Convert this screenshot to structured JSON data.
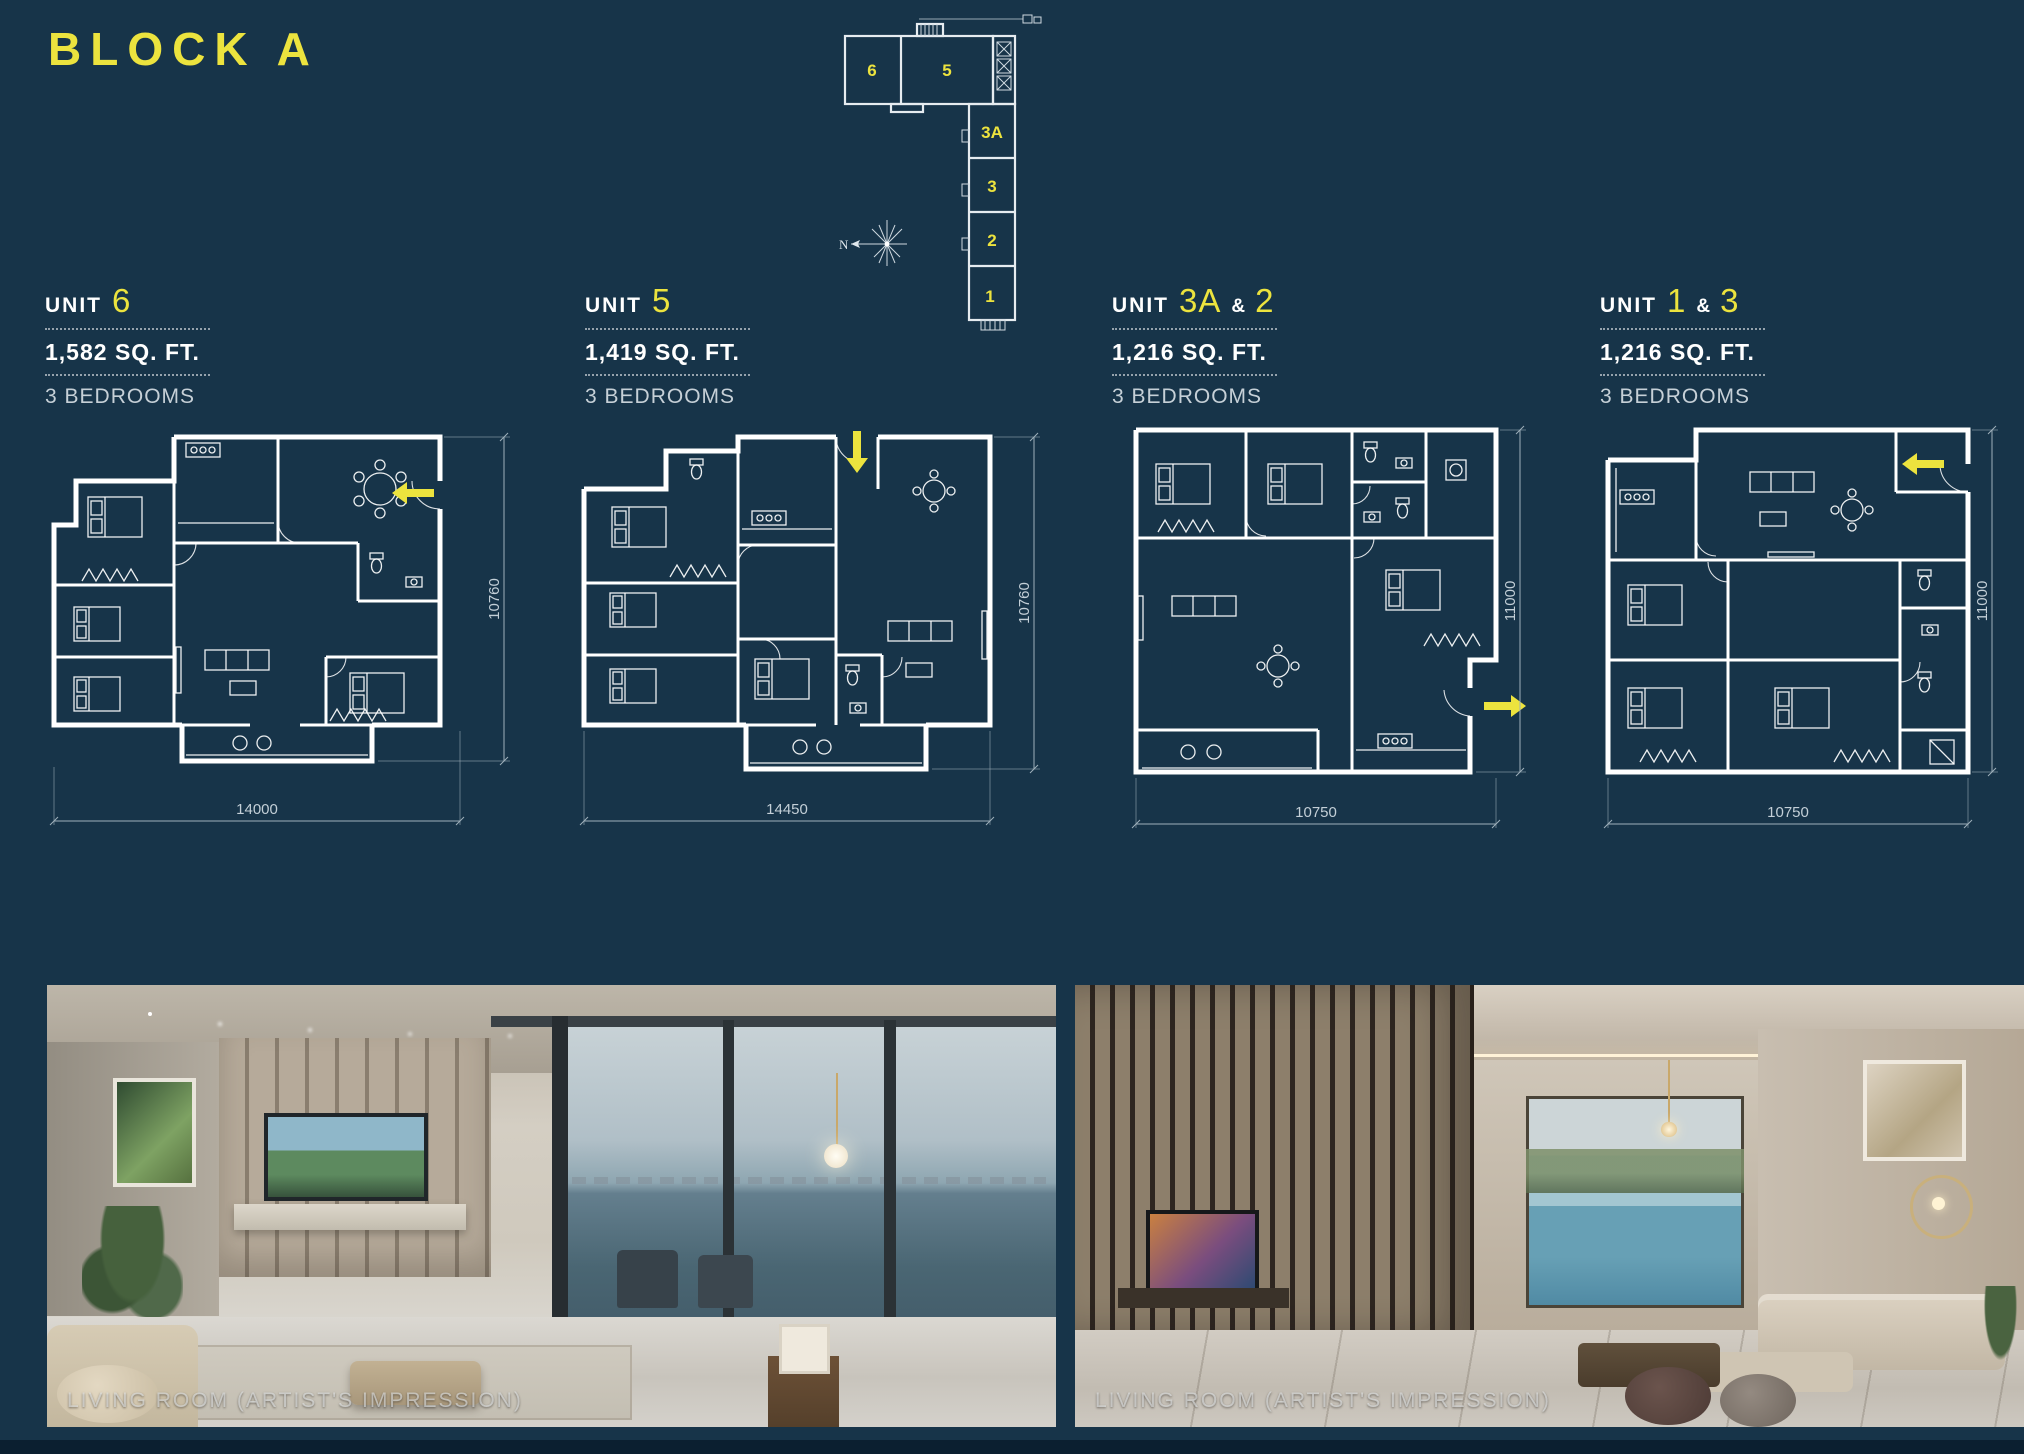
{
  "page": {
    "title": "BLOCK A"
  },
  "colors": {
    "background": "#173449",
    "accent": "#ece33e",
    "wall_white": "#ffffff",
    "dim_gray": "#c3cfd7"
  },
  "key_plan": {
    "north_label": "N",
    "unit_labels": [
      "6",
      "5",
      "3A",
      "3",
      "2",
      "1"
    ]
  },
  "units": [
    {
      "label_unit": "UNIT",
      "num_a": "6",
      "area": "1,582 SQ. FT.",
      "bedrooms": "3 BEDROOMS",
      "width_label": "14000",
      "height_label": "10760"
    },
    {
      "label_unit": "UNIT",
      "num_a": "5",
      "area": "1,419 SQ. FT.",
      "bedrooms": "3 BEDROOMS",
      "width_label": "14450",
      "height_label": "10760"
    },
    {
      "label_unit": "UNIT",
      "num_a": "3A",
      "sep": "&",
      "num_b": "2",
      "area": "1,216 SQ. FT.",
      "bedrooms": "3 BEDROOMS",
      "width_label": "10750",
      "height_label": "11000"
    },
    {
      "label_unit": "UNIT",
      "num_a": "1",
      "sep": "&",
      "num_b": "3",
      "area": "1,216 SQ. FT.",
      "bedrooms": "3 BEDROOMS",
      "width_label": "10750",
      "height_label": "11000"
    }
  ],
  "photos": [
    {
      "caption": "LIVING ROOM (ARTIST'S IMPRESSION)"
    },
    {
      "caption": "LIVING ROOM (ARTIST'S IMPRESSION)"
    }
  ]
}
